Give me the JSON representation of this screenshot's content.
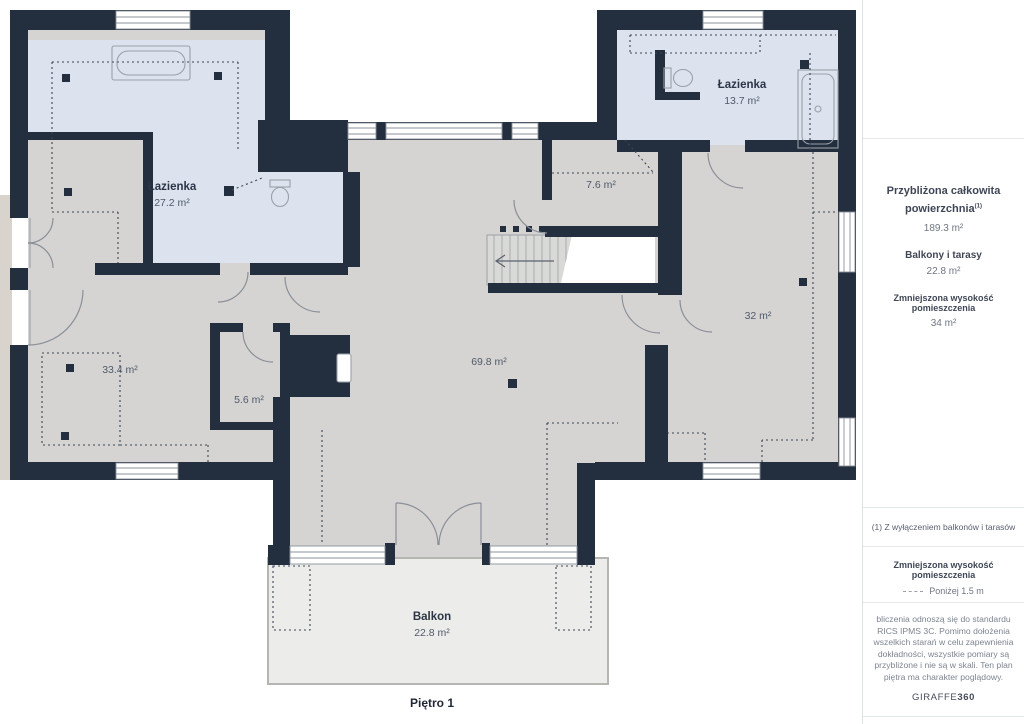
{
  "floor_label": "Piętro 1",
  "rooms": {
    "bath_left": {
      "name": "Łazienka",
      "area": "27.2 m²"
    },
    "bath_right": {
      "name": "Łazienka",
      "area": "13.7 m²"
    },
    "hall": {
      "area": "7.6 m²"
    },
    "room_32": {
      "area": "32 m²"
    },
    "room_334": {
      "area": "33.4 m²"
    },
    "room_56": {
      "area": "5.6 m²"
    },
    "living": {
      "area": "69.8 m²"
    },
    "balcony": {
      "name": "Balkon",
      "area": "22.8 m²"
    }
  },
  "sidebar": {
    "total_label_line1": "Przybliżona całkowita",
    "total_label_line2": "powierzchnia",
    "total_sup": "(1)",
    "total_value": "189.3 m²",
    "balconies_label": "Balkony i tarasy",
    "balconies_value": "22.8 m²",
    "reduced_label": "Zmniejszona wysokość pomieszczenia",
    "reduced_value": "34 m²",
    "footnote": "(1) Z wyłączeniem balkonów i tarasów",
    "legend_title": "Zmniejszona wysokość pomieszczenia",
    "legend_item": "Poniżej 1.5 m",
    "disclaimer": "bliczenia odnoszą się do standardu RICS IPMS 3C. Pomimo dołożenia wszelkich starań w celu zapewnienia dokładności, wszystkie pomiary są przybliżone i nie są w skali. Ten plan piętra ma charakter poglądowy.",
    "brand_regular": "GIRAFFE",
    "brand_bold": "360"
  },
  "colors": {
    "wall": "#232e3e",
    "floor": "#d5d4d2",
    "bathroom": "#dce3ef",
    "balcony": "#ecedea",
    "outside": "#ffffff"
  }
}
